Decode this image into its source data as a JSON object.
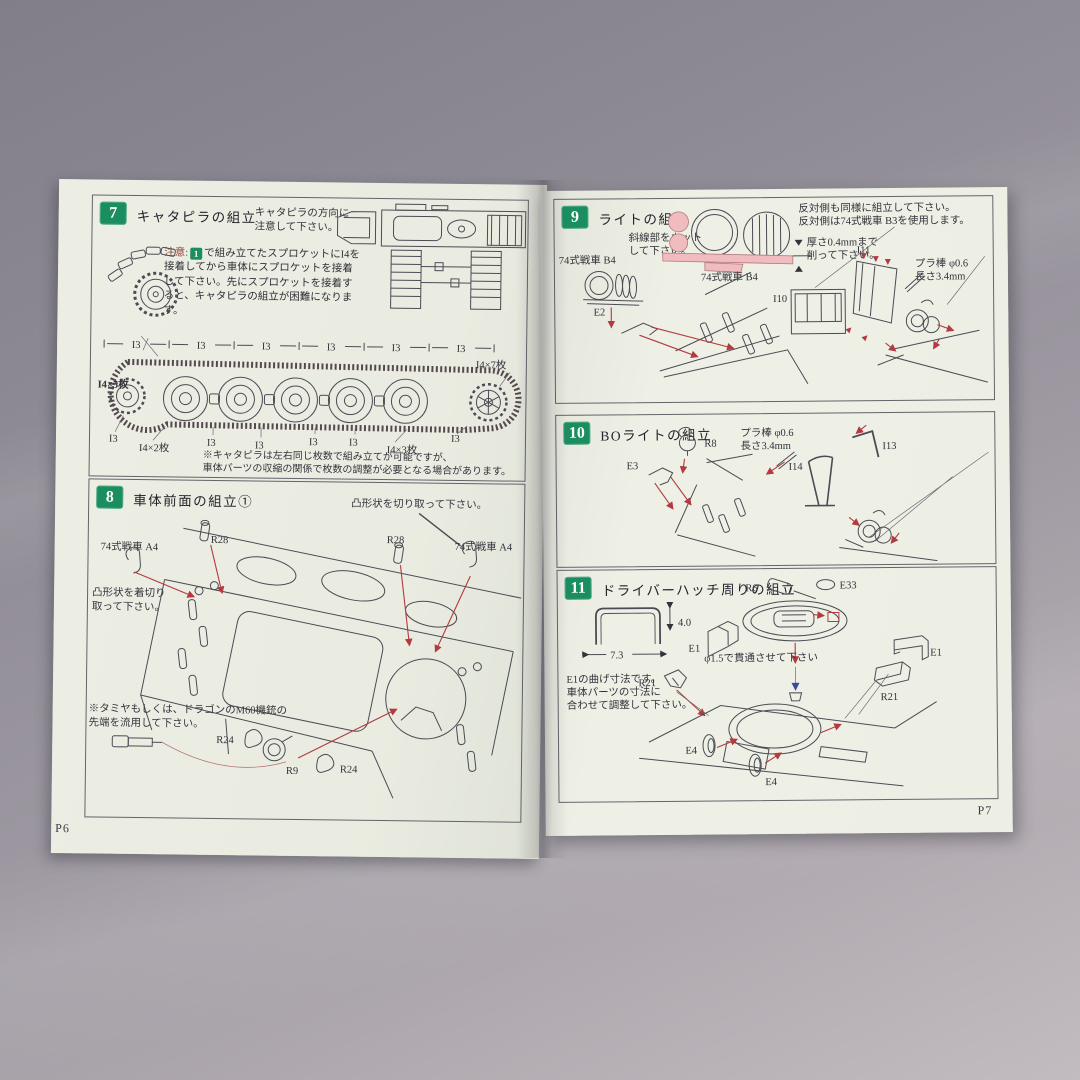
{
  "colors": {
    "step_badge_green": "#1b8e5f",
    "arrow_red": "#b23a40",
    "hatched_pink": "#f0bcc0",
    "page_paper": "#ebeee3"
  },
  "left_page": {
    "page_number": "P6",
    "step7": {
      "number": "7",
      "title": "キャタピラの組立",
      "direction_note_l1": "キャタピラの方向に",
      "direction_note_l2": "注意して下さい。",
      "caution_word": "注意:",
      "caution_badge": "1",
      "caution_text": "で組み立てたスプロケットにI4を接着してから車体にスプロケットを接着して下さい。先にスプロケットを接着すると、キャタピラの組立が困難になります。",
      "track": {
        "left_count": "I4×5枚",
        "top_right_count": "I4×7枚",
        "top_labels": [
          "I3",
          "I3",
          "I3",
          "I3",
          "I3",
          "I3"
        ],
        "bottom_labels": [
          "I3",
          "I4×2枚",
          "I3",
          "I3",
          "I3",
          "I3",
          "I4×3枚",
          "I3"
        ]
      },
      "footnote_l1": "※キャタピラは左右同じ枚数で組み立てが可能ですが、",
      "footnote_l2": "車体パーツの収縮の関係で枚数の調整が必要となる場合があります。"
    },
    "step8": {
      "number": "8",
      "title": "車体前面の組立①",
      "cut_note": "凸形状を切り取って下さい。",
      "part_a4": "74式戦車  A4",
      "r28": "R28",
      "left_note_l1": "凸形状を着切り",
      "left_note_l2": "取って下さい。",
      "bottom_note_l1": "※タミヤもしくは、ドラゴンのM60機銃の",
      "bottom_note_l2": "先端を流用して下さい。",
      "r24": "R24",
      "r9": "R9"
    }
  },
  "right_page": {
    "page_number": "P7",
    "step9": {
      "number": "9",
      "title": "ライトの組立",
      "opposite_l1": "反対側も同様に組立して下さい。",
      "opposite_l2": "反対側は74式戦車  B3を使用します。",
      "hatch_l1": "斜線部をカット",
      "hatch_l2": "して下さい。",
      "thickness_l1": "厚さ0.4mmまで",
      "thickness_l2": "削って下さい。",
      "part_b4": "74式戦車  B4",
      "i11": "I11",
      "i10": "I10",
      "e2": "E2",
      "rod_l1": "プラ棒 φ0.6",
      "rod_l2": "長さ3.4mm"
    },
    "step10": {
      "number": "10",
      "title": "BOライトの組立",
      "r8": "R8",
      "e3": "E3",
      "i13": "I13",
      "i14": "I14",
      "rod_l1": "プラ棒 φ0.6",
      "rod_l2": "長さ3.4mm"
    },
    "step11": {
      "number": "11",
      "title": "ドライバーハッチ周りの組立",
      "r6": "R6",
      "e33": "E33",
      "e1": "E1",
      "r21": "R21",
      "e4": "E4",
      "dim_h": "4.0",
      "dim_w": "7.3",
      "drill_note": "φ1.5で貫通させて下さい",
      "bend_l1": "E1の曲げ寸法です。",
      "bend_l2": "車体パーツの寸法に",
      "bend_l3": "合わせて調整して下さい。"
    }
  }
}
